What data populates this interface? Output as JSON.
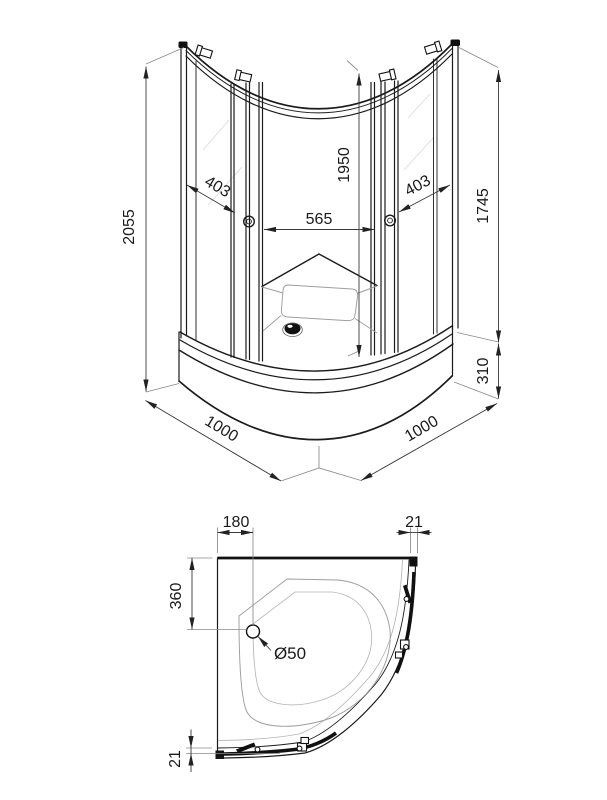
{
  "palette": {
    "ink": "#1a1a1a",
    "paper": "#ffffff"
  },
  "front_view": {
    "labels": {
      "total_height": "2055",
      "left_opening": "403",
      "center_width": "565",
      "door_height": "1950",
      "right_opening": "403",
      "side_height": "1745",
      "tray_height": "310",
      "width_left": "1000",
      "width_right": "1000"
    }
  },
  "top_view": {
    "labels": {
      "drain_from_side": "180",
      "top_profile_width": "21",
      "drain_from_back": "360",
      "drain_diameter": "Ø50",
      "front_profile_width": "21"
    }
  }
}
